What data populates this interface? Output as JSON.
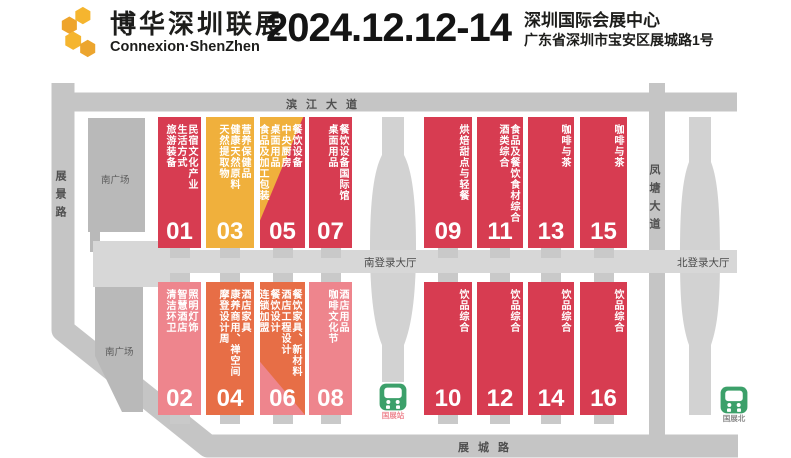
{
  "header": {
    "logo": {
      "title": "博华深圳联展",
      "subtitle": "Connexion·ShenZhen"
    },
    "dates": "2024.12.12-14",
    "venue": {
      "name": "深圳国际会展中心",
      "address": "广东省深圳市宝安区展城路1号"
    }
  },
  "map": {
    "roads": {
      "top": "滨江大道",
      "left": "展景路",
      "right": "凤塘大道",
      "bottom": "展城路"
    },
    "areas": {
      "south_plaza_upper": "南广场",
      "south_plaza_lower": "南广场",
      "south_login_hall": "南登录大厅",
      "north_login_hall": "北登录大厅"
    },
    "stations": [
      {
        "name": "国展站"
      },
      {
        "name": "国展北"
      }
    ],
    "colors": {
      "hall_red": "#d73c51",
      "hall_pink": "#ee858d",
      "hall_orange": "#e76e46",
      "hall_yellow": "#f0b03c",
      "road_gray": "#c5c5c5",
      "plaza_gray": "#b9b9b9",
      "corridor_gray": "#d7d7d7",
      "station_green": "#3ca06a",
      "logo_gold": "#f2b22d"
    },
    "halls": [
      {
        "number": "01",
        "topics": [
          "民宿文化产业",
          "生活方式",
          "旅游装备"
        ]
      },
      {
        "number": "03",
        "topics": [
          "营养保健品",
          "健康天然原料",
          "天然提取物"
        ]
      },
      {
        "number": "05",
        "topics": [
          "餐饮设备",
          "中央厨房",
          "桌面用品",
          "食品及加工包装"
        ]
      },
      {
        "number": "07",
        "topics": [
          "餐饮设备国际馆",
          "桌面用品"
        ]
      },
      {
        "number": "09",
        "topics": [
          "烘焙甜点与轻餐"
        ]
      },
      {
        "number": "11",
        "topics": [
          "食品及餐饮食材综合",
          "酒类综合"
        ]
      },
      {
        "number": "13",
        "topics": [
          "咖啡与茶"
        ]
      },
      {
        "number": "15",
        "topics": [
          "咖啡与茶"
        ]
      },
      {
        "number": "02",
        "topics": [
          "照明灯饰",
          "智慧酒店",
          "清洁环卫"
        ]
      },
      {
        "number": "04",
        "topics": [
          "酒店家具",
          "康养商用、禅空间",
          "摩登设计周"
        ]
      },
      {
        "number": "06",
        "topics": [
          "餐饮家具、新材料",
          "酒店工程设计",
          "餐饮设计",
          "连锁加盟"
        ]
      },
      {
        "number": "08",
        "topics": [
          "酒店用品",
          "咖啡文化节"
        ]
      },
      {
        "number": "10",
        "topics": [
          "饮品综合"
        ]
      },
      {
        "number": "12",
        "topics": [
          "饮品综合"
        ]
      },
      {
        "number": "14",
        "topics": [
          "饮品综合"
        ]
      },
      {
        "number": "16",
        "topics": [
          "饮品综合"
        ]
      }
    ]
  }
}
